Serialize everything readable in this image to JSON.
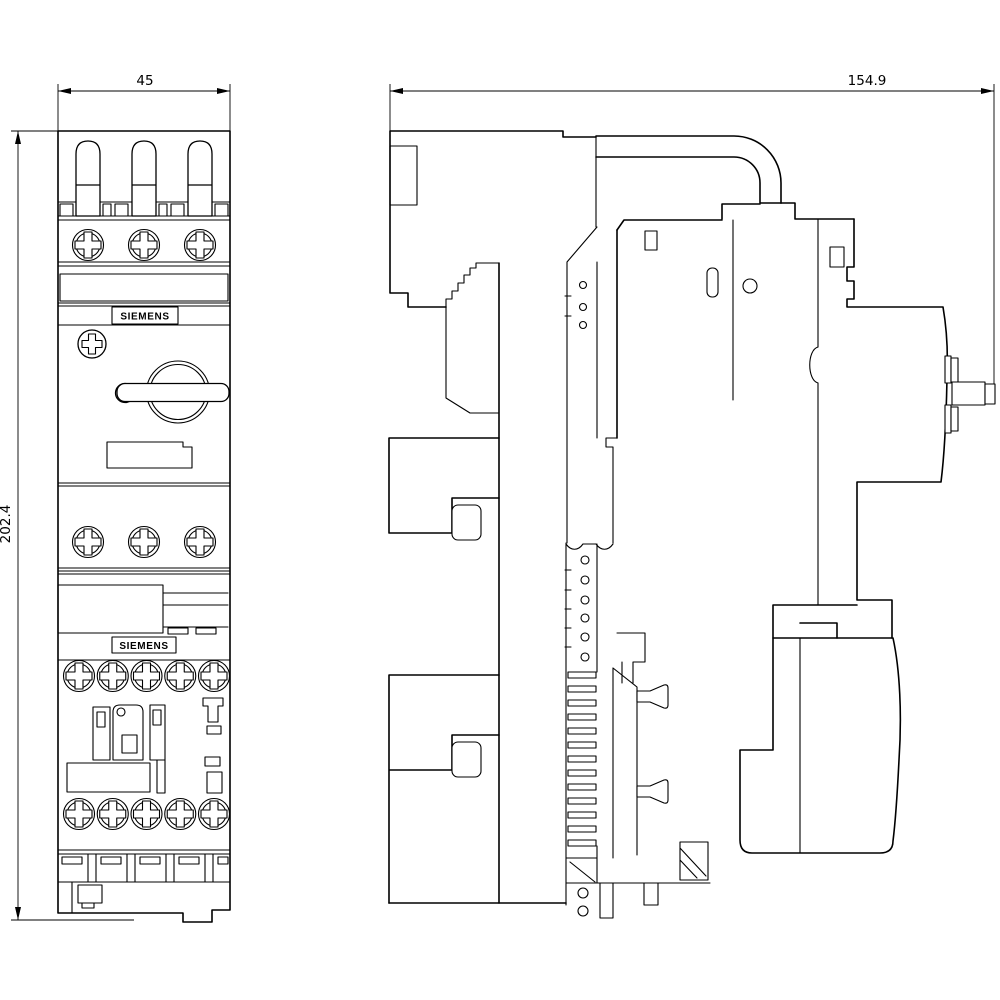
{
  "colors": {
    "background": "#ffffff",
    "line": "#000000"
  },
  "dims": {
    "front_width": "45",
    "side_width": "154.9",
    "height": "202.4"
  },
  "labels": {
    "brand_top": "SIEMENS",
    "brand_bottom": "SIEMENS"
  }
}
